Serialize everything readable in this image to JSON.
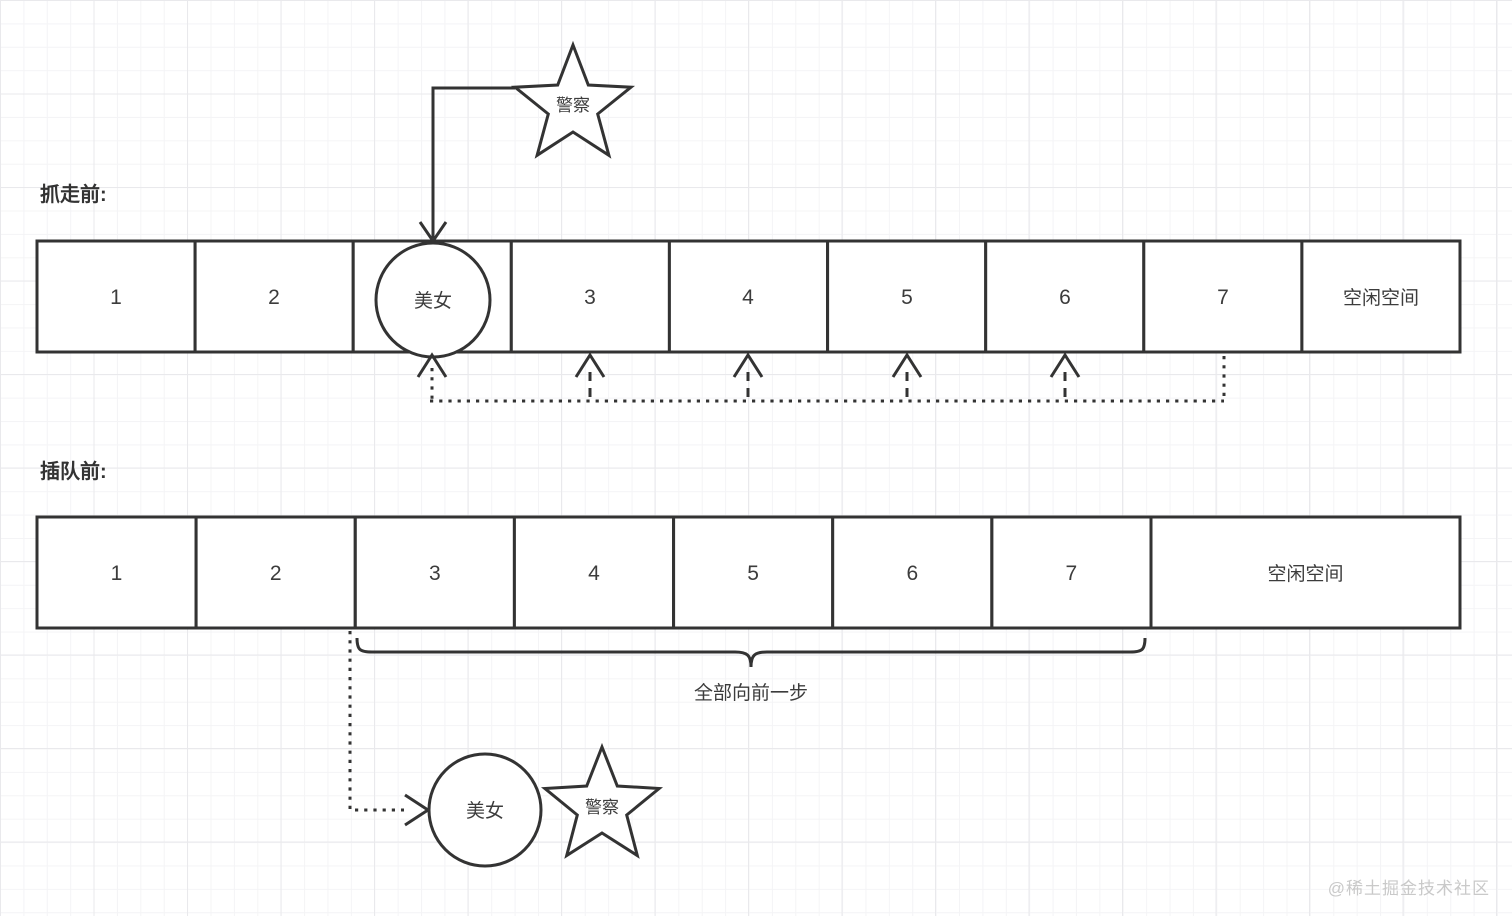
{
  "diagram": {
    "sections": {
      "before_taken_label": "抓走前:",
      "before_cut_label": "插队前:"
    },
    "actors": {
      "police": "警察",
      "beauty": "美女"
    },
    "row1_cells": [
      "1",
      "2",
      "",
      "3",
      "4",
      "5",
      "6",
      "7",
      "空闲空间"
    ],
    "row2_cells": [
      "1",
      "2",
      "3",
      "4",
      "5",
      "6",
      "7",
      "空闲空间"
    ],
    "annotation": "全部向前一步",
    "watermark": "@稀土掘金技术社区"
  },
  "colors": {
    "stroke": "#333333",
    "text": "#3c3c3c",
    "watermark": "#c9c9c9",
    "grid_minor": "#f4f4f6",
    "grid_major": "#e9e9ec",
    "background": "#ffffff"
  }
}
